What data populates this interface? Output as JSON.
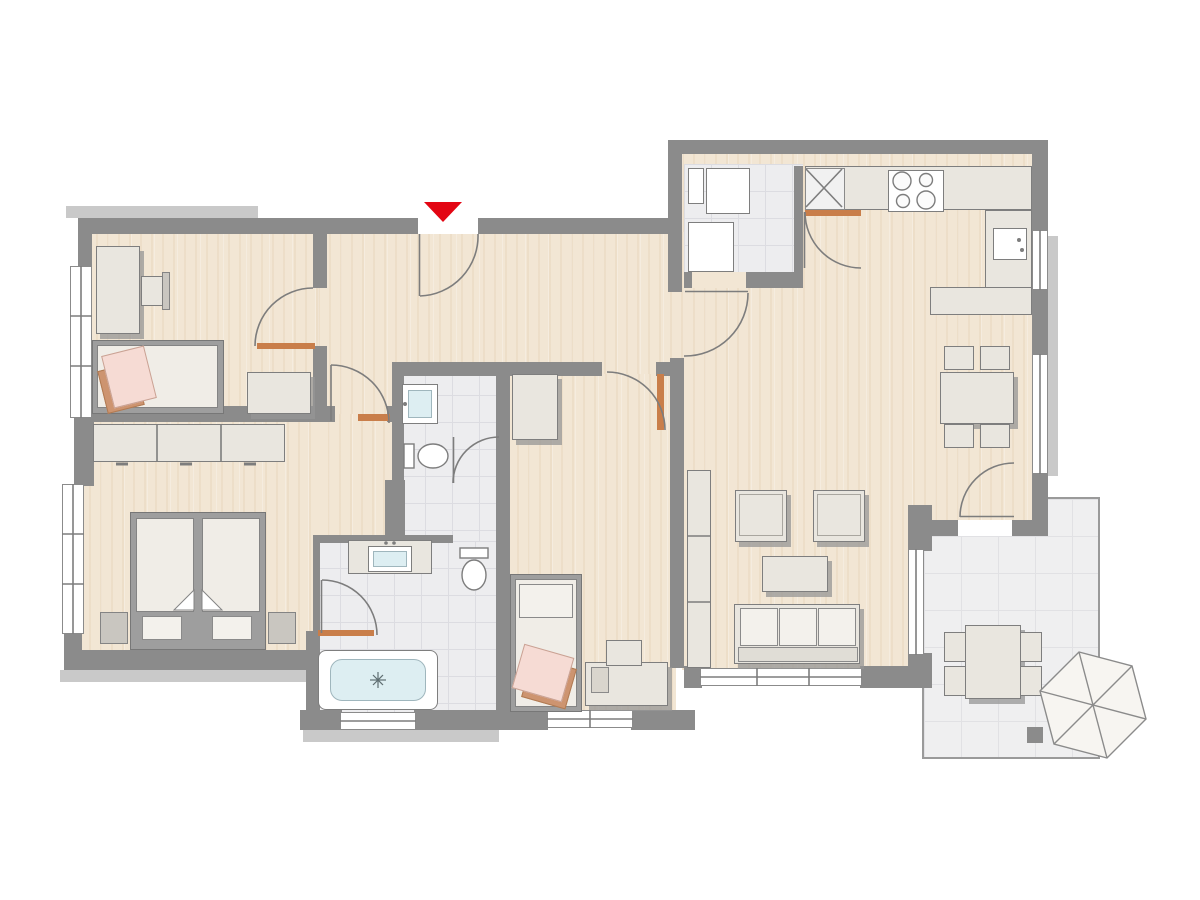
{
  "document": {
    "kind": "architectural-floor-plan",
    "description": "2D apartment floor plan, no text labels, entrance marked with red triangle at top"
  },
  "colors": {
    "wall": "#8b8b8b",
    "trim": "#c9c9c9",
    "wood": "#f2e6d4",
    "tile": "#ededef",
    "terrace": "#efeff0",
    "furniture": "#e9e6df",
    "furnitureBorder": "#7e7e7e",
    "water": "#ddeef2",
    "pink": "#f6dbd4",
    "tan": "#cd9470",
    "doorSill": "#c97e4a",
    "entranceMarker": "#e30613",
    "doorSwingLine": "#7d7d7d"
  },
  "entrance": {
    "marker": "red-triangle-down",
    "location": "top-center"
  },
  "rooms": [
    {
      "name": "room-top-left",
      "floor": "wood",
      "furniture": [
        "desk",
        "desk-chair",
        "single-bed-with-pink-blanket",
        "dresser"
      ]
    },
    {
      "name": "bedroom-bottom-left",
      "floor": "wood",
      "furniture": [
        "double-bed",
        "nightstand-left",
        "nightstand-right",
        "sideboard"
      ]
    },
    {
      "name": "hallway",
      "floor": "wood",
      "furniture": []
    },
    {
      "name": "wc",
      "floor": "tile",
      "furniture": [
        "washbasin",
        "toilet"
      ]
    },
    {
      "name": "bathroom",
      "floor": "tile",
      "furniture": [
        "vanity-washbasin",
        "toilet",
        "bathtub"
      ]
    },
    {
      "name": "child-room-bottom-center",
      "floor": "wood",
      "furniture": [
        "wardrobe",
        "single-bed-with-pink-blanket",
        "desk",
        "desk-chair"
      ]
    },
    {
      "name": "utility-room",
      "floor": "tile",
      "furniture": [
        "appliance-1",
        "appliance-2"
      ]
    },
    {
      "name": "kitchen",
      "floor": "wood",
      "furniture": [
        "l-shaped-counter",
        "corner-unit",
        "cooktop-4-burners",
        "sink",
        "dining-table",
        "four-chairs"
      ]
    },
    {
      "name": "living-room",
      "floor": "wood",
      "furniture": [
        "tall-cabinet",
        "armchair-1",
        "armchair-2",
        "coffee-table",
        "three-seat-sofa"
      ]
    },
    {
      "name": "terrace",
      "floor": "outdoor-tile",
      "furniture": [
        "outdoor-table",
        "four-outdoor-chairs",
        "hexagonal-parasol"
      ]
    }
  ],
  "openings": {
    "doors_with_swing_arcs": 9,
    "windows": 8
  }
}
